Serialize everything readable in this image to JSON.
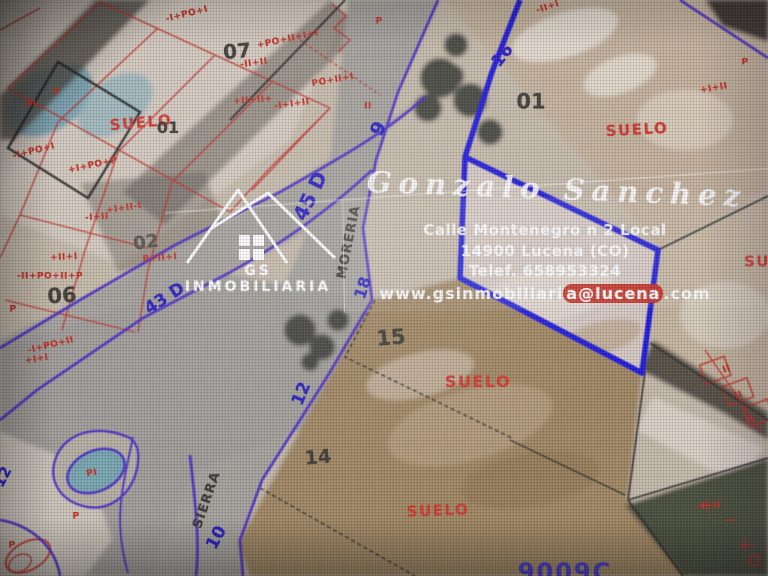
{
  "watermark": {
    "logo_text": "GS INMOBILIARIA",
    "agent_name": "Gonzalo Sanchez",
    "address_line": "Calle Montenegro n 2 Local",
    "city_line": "14900 Lucena (CO)",
    "phone_line": "Telef. 658953324",
    "web_pre": "www.gsinmobiliari",
    "web_highlight": "a@lucena",
    "web_post": ".com"
  },
  "map": {
    "region_labels": [
      {
        "text": "SUELO"
      },
      {
        "text": "SUELO"
      },
      {
        "text": "SUELO"
      },
      {
        "text": "SUELO"
      },
      {
        "text": "SUELO"
      }
    ],
    "parcel_numbers": [
      {
        "text": "01"
      },
      {
        "text": "07"
      },
      {
        "text": "02"
      },
      {
        "text": "06"
      },
      {
        "text": "01"
      },
      {
        "text": "15"
      },
      {
        "text": "14"
      }
    ],
    "road_numbers": [
      {
        "text": "16"
      },
      {
        "text": "9"
      },
      {
        "text": "45 D"
      },
      {
        "text": "18"
      },
      {
        "text": "12"
      },
      {
        "text": "10"
      },
      {
        "text": "43 D"
      },
      {
        "text": "12"
      }
    ],
    "street_names": [
      {
        "text": "MORERIA"
      },
      {
        "text": "SIERRA"
      }
    ],
    "cadastral_marks": [
      {
        "text": "-I+PO+I"
      },
      {
        "text": "+PO+II+I+I"
      },
      {
        "text": "PO+II+I"
      },
      {
        "text": "-II+II"
      },
      {
        "text": "+II+II+"
      },
      {
        "text": "-I+I+II"
      },
      {
        "text": "P"
      },
      {
        "text": "-II+I"
      },
      {
        "text": "-I+PO+I"
      },
      {
        "text": "+I+PO+P"
      },
      {
        "text": "-I+II"
      },
      {
        "text": "+I+II-I"
      },
      {
        "text": "+II+I"
      },
      {
        "text": "-II+PO+II+P"
      },
      {
        "text": "P+II+I"
      },
      {
        "text": "P"
      },
      {
        "text": "-I+PO+II"
      },
      {
        "text": "+I+I"
      },
      {
        "text": "PI"
      },
      {
        "text": "P"
      },
      {
        "text": "P"
      },
      {
        "text": "PI"
      },
      {
        "text": "P"
      },
      {
        "text": "II"
      },
      {
        "text": "-I+II"
      },
      {
        "text": "II"
      },
      {
        "text": "II"
      },
      {
        "text": "II"
      },
      {
        "text": "P"
      },
      {
        "text": "+I+II"
      }
    ],
    "bottom_code": "9009C",
    "colors": {
      "parcel_highlight": "#1b12e8",
      "road_edge_purple": "#4a2ad2",
      "cadastral_red": "#d02a1e",
      "road_label_blue": "#2418cc",
      "suelo_red": "#d8382c"
    }
  }
}
